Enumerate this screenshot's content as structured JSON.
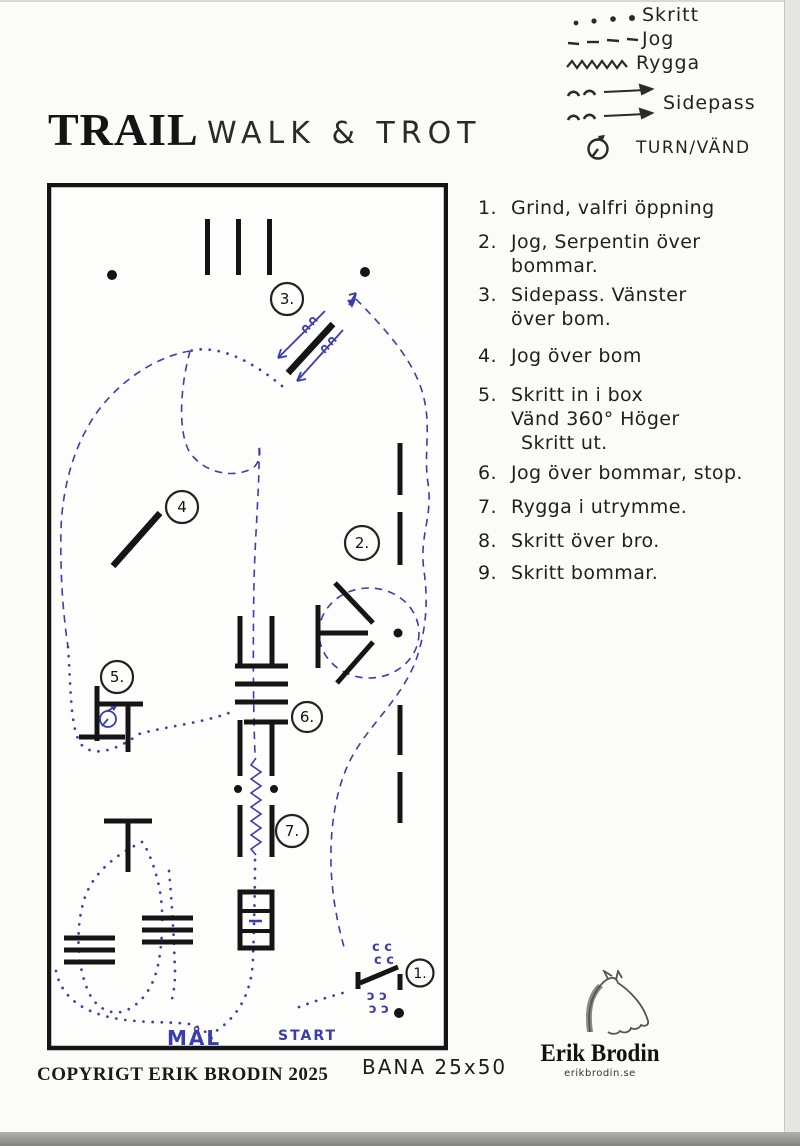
{
  "title": {
    "main": "TRAIL",
    "sub": "WALK & TROT"
  },
  "legend": {
    "skritt": "Skritt",
    "jog": "Jog",
    "rygga": "Rygga",
    "sidepass": "Sidepass",
    "turn": "TURN/VÄND"
  },
  "obstacles": {
    "items": [
      {
        "num": "1.",
        "lines": [
          "Grind, valfri öppning"
        ]
      },
      {
        "num": "2.",
        "lines": [
          "Jog, Serpentin över",
          "bommar."
        ]
      },
      {
        "num": "3.",
        "lines": [
          "Sidepass. Vänster",
          "över bom."
        ]
      },
      {
        "num": "4.",
        "lines": [
          "Jog över bom"
        ]
      },
      {
        "num": "5.",
        "lines": [
          "Skritt in i box",
          "Vänd 360° Höger",
          "Skritt ut."
        ]
      },
      {
        "num": "6.",
        "lines": [
          "Jog över bommar, stop."
        ]
      },
      {
        "num": "7.",
        "lines": [
          "Rygga i utrymme."
        ]
      },
      {
        "num": "8.",
        "lines": [
          "Skritt över bro."
        ]
      },
      {
        "num": "9.",
        "lines": [
          "Skritt bommar."
        ]
      }
    ]
  },
  "map": {
    "labels": {
      "o1": "1.",
      "o2": "2.",
      "o3": "3.",
      "o4": "4",
      "o5": "5.",
      "o6": "6.",
      "o7": "7."
    },
    "mal": "MÅL",
    "start": "START"
  },
  "footer": {
    "copyright": "COPYRIGT ERIK BRODIN 2025",
    "bana": "BANA 25x50"
  },
  "brand": {
    "name": "Erik Brodin",
    "site": "erikbrodin.se"
  },
  "colors": {
    "ink": "#1b1b1b",
    "blue": "#3a3db0",
    "paper": "#fbfbf8"
  }
}
